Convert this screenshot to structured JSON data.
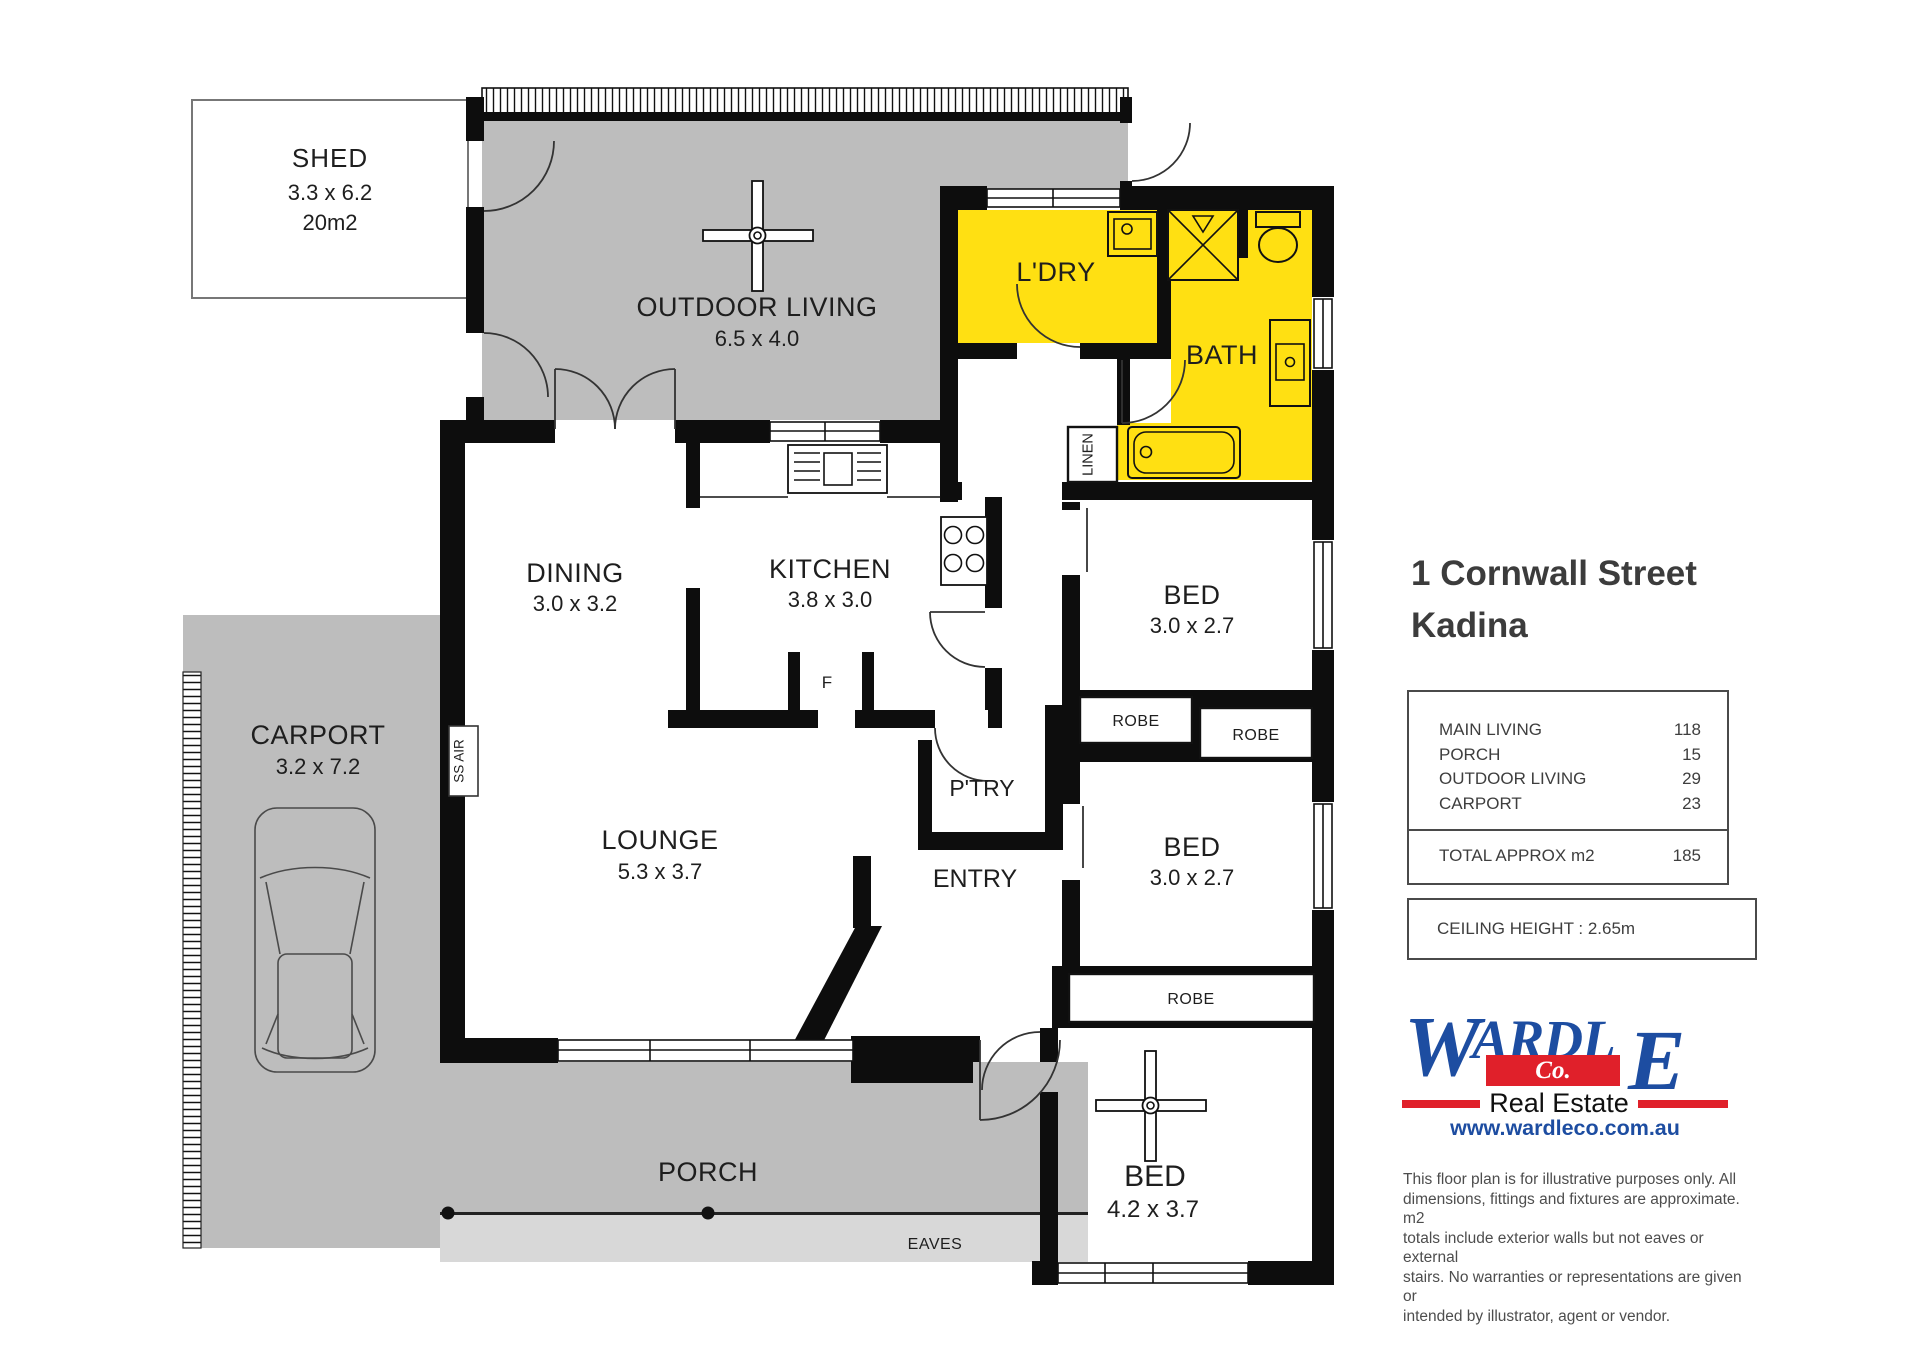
{
  "colors": {
    "highlight": "#ffe012",
    "area-gray": "#bdbdbd",
    "eaves-gray": "#d8d8d8",
    "wall": "#0d0d0d",
    "brand-blue": "#1d4da1",
    "brand-red": "#e0202a",
    "ink": "#1e1e1e",
    "panel-ink": "#3e3e3e"
  },
  "plan": {
    "shed": {
      "title": "SHED",
      "dims": "3.3 x 6.2",
      "area": "20m2"
    },
    "outdoor_living": {
      "title": "OUTDOOR LIVING",
      "dims": "6.5 x 4.0"
    },
    "laundry": {
      "title": "L'DRY"
    },
    "bath": {
      "title": "BATH"
    },
    "linen": {
      "title": "LINEN"
    },
    "dining": {
      "title": "DINING",
      "dims": "3.0 x 3.2"
    },
    "kitchen": {
      "title": "KITCHEN",
      "dims": "3.8 x 3.0"
    },
    "fridge": {
      "title": "F"
    },
    "pantry": {
      "title": "P'TRY"
    },
    "ss_air": {
      "title": "SS AIR"
    },
    "lounge": {
      "title": "LOUNGE",
      "dims": "5.3 x 3.7"
    },
    "entry": {
      "title": "ENTRY"
    },
    "bed1": {
      "title": "BED",
      "dims": "3.0 x 2.7"
    },
    "bed2": {
      "title": "BED",
      "dims": "3.0 x 2.7"
    },
    "bed3": {
      "title": "BED",
      "dims": "4.2 x 3.7"
    },
    "robe1": {
      "title": "ROBE"
    },
    "robe2": {
      "title": "ROBE"
    },
    "robe3": {
      "title": "ROBE"
    },
    "porch": {
      "title": "PORCH"
    },
    "eaves": {
      "title": "EAVES"
    },
    "carport": {
      "title": "CARPORT",
      "dims": "3.2 x 7.2"
    }
  },
  "panel": {
    "address_line1": "1 Cornwall Street",
    "address_line2": "Kadina",
    "areas": {
      "rows": [
        {
          "label": "MAIN LIVING",
          "value": "118"
        },
        {
          "label": "PORCH",
          "value": "15"
        },
        {
          "label": "OUTDOOR LIVING",
          "value": "29"
        },
        {
          "label": "CARPORT",
          "value": "23"
        }
      ],
      "total_label": "TOTAL APPROX m2",
      "total_value": "185"
    },
    "ceiling": "CEILING HEIGHT : 2.65m",
    "logo": {
      "part1": "W",
      "part2": "ARDL",
      "part3": "E",
      "co": "Co.",
      "tagline": "Real Estate",
      "website": "www.wardleco.com.au"
    },
    "disclaimer": [
      "This floor plan is for illustrative purposes only. All",
      "dimensions, fittings and fixtures are approximate. m2",
      "totals include exterior walls but not eaves or external",
      "stairs. No warranties or representations are given or",
      "intended by illustrator, agent or vendor."
    ]
  }
}
